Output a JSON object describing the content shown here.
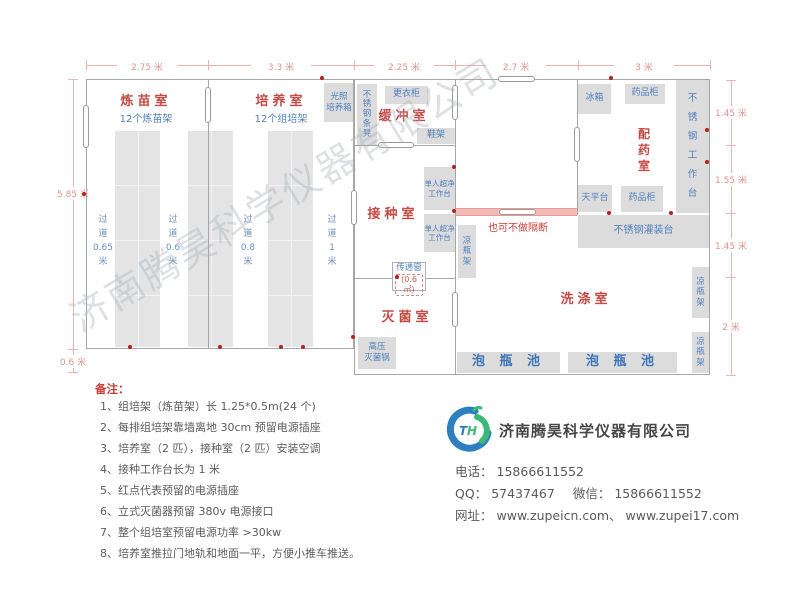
{
  "dimensions": {
    "top": [
      "2.75 米",
      "3.3 米",
      "2.25 米",
      "2.7 米",
      "3 米"
    ],
    "left_height": "5.85 米",
    "left_offset": "0.6 米",
    "right": [
      "1.45 米",
      "1.55 米",
      "1.45 米",
      "2 米"
    ]
  },
  "rooms": {
    "seedling": {
      "name": "炼苗室",
      "subtitle": "12个炼苗架"
    },
    "culture": {
      "name": "培养室",
      "subtitle": "12个组培架"
    },
    "buffer": {
      "name": "缓冲室"
    },
    "inoculation": {
      "name": "接种室"
    },
    "sterilization": {
      "name": "灭菌室"
    },
    "washing": {
      "name": "洗涤室"
    },
    "dispensing": {
      "name": "配\n药\n室"
    }
  },
  "aisles": [
    "过\n道\n0.65\n米",
    "过\n道\n0.6\n米",
    "过\n道\n0.8\n米",
    "过\n道\n1\n米"
  ],
  "furniture": {
    "light_incubator": "光照\n培养箱",
    "steel_bench": "不\n锈\n钢\n条\n凳",
    "wardrobe": "更衣柜",
    "shoe_rack": "鞋架",
    "clean_bench": "单人超净\n工作台",
    "bottle_rack_v": "凉\n瓶\n架",
    "autoclave": "高压\n灭菌锅",
    "soak_pool": "泡 瓶 池",
    "filling_table": "不锈钢灌装台",
    "fridge": "冰箱",
    "medicine_cabinet": "药品柜",
    "steel_worktable": "不\n锈\n钢\n工\n作\n台",
    "balance_table": "天平台"
  },
  "labels": {
    "optional_partition": "也可不做隔断",
    "transfer_window": "传递窗",
    "transfer_window_area": "(0.6㎡)"
  },
  "notes": {
    "title": "备注：",
    "items": [
      "1、组培架（炼苗架）长 1.25*0.5m(24 个)",
      "2、每排组培架靠墙离地 30cm 预留电源插座",
      "3、培养室（2 匹），接种室（2 匹）安装空调",
      "4、接种工作台长为 1 米",
      "5、红点代表预留的电源插座",
      "6、立式灭菌器预留 380v 电源接口",
      "7、整个组培室预留电源功率 >30kw",
      "8、培养室推拉门地轨和地面一平，方便小推车推送。"
    ]
  },
  "company": {
    "logo_monogram": "TH",
    "name": "济南腾昊科学仪器有限公司",
    "phone_label": "电话：",
    "phone": "15866611552",
    "qq_label": "QQ：",
    "qq": "57437467",
    "wechat_label": "微信：",
    "wechat": "15866611552",
    "website_label": "网址：",
    "websites": "www.zupeicn.com、 www.zupei17.com"
  },
  "watermark": "济南腾昊科学仪器有限公司",
  "colors": {
    "room_label": "#c64a43",
    "furniture_text": "#4f7fbd",
    "dimension": "#e2928c",
    "wall": "#a6a6a6",
    "furniture_fill": "#dcdcdc",
    "outlet_dot": "#b32020",
    "partition_band": "#f4bcb8",
    "logo_blue": "#2e7fc0",
    "logo_green": "#3cb878"
  }
}
